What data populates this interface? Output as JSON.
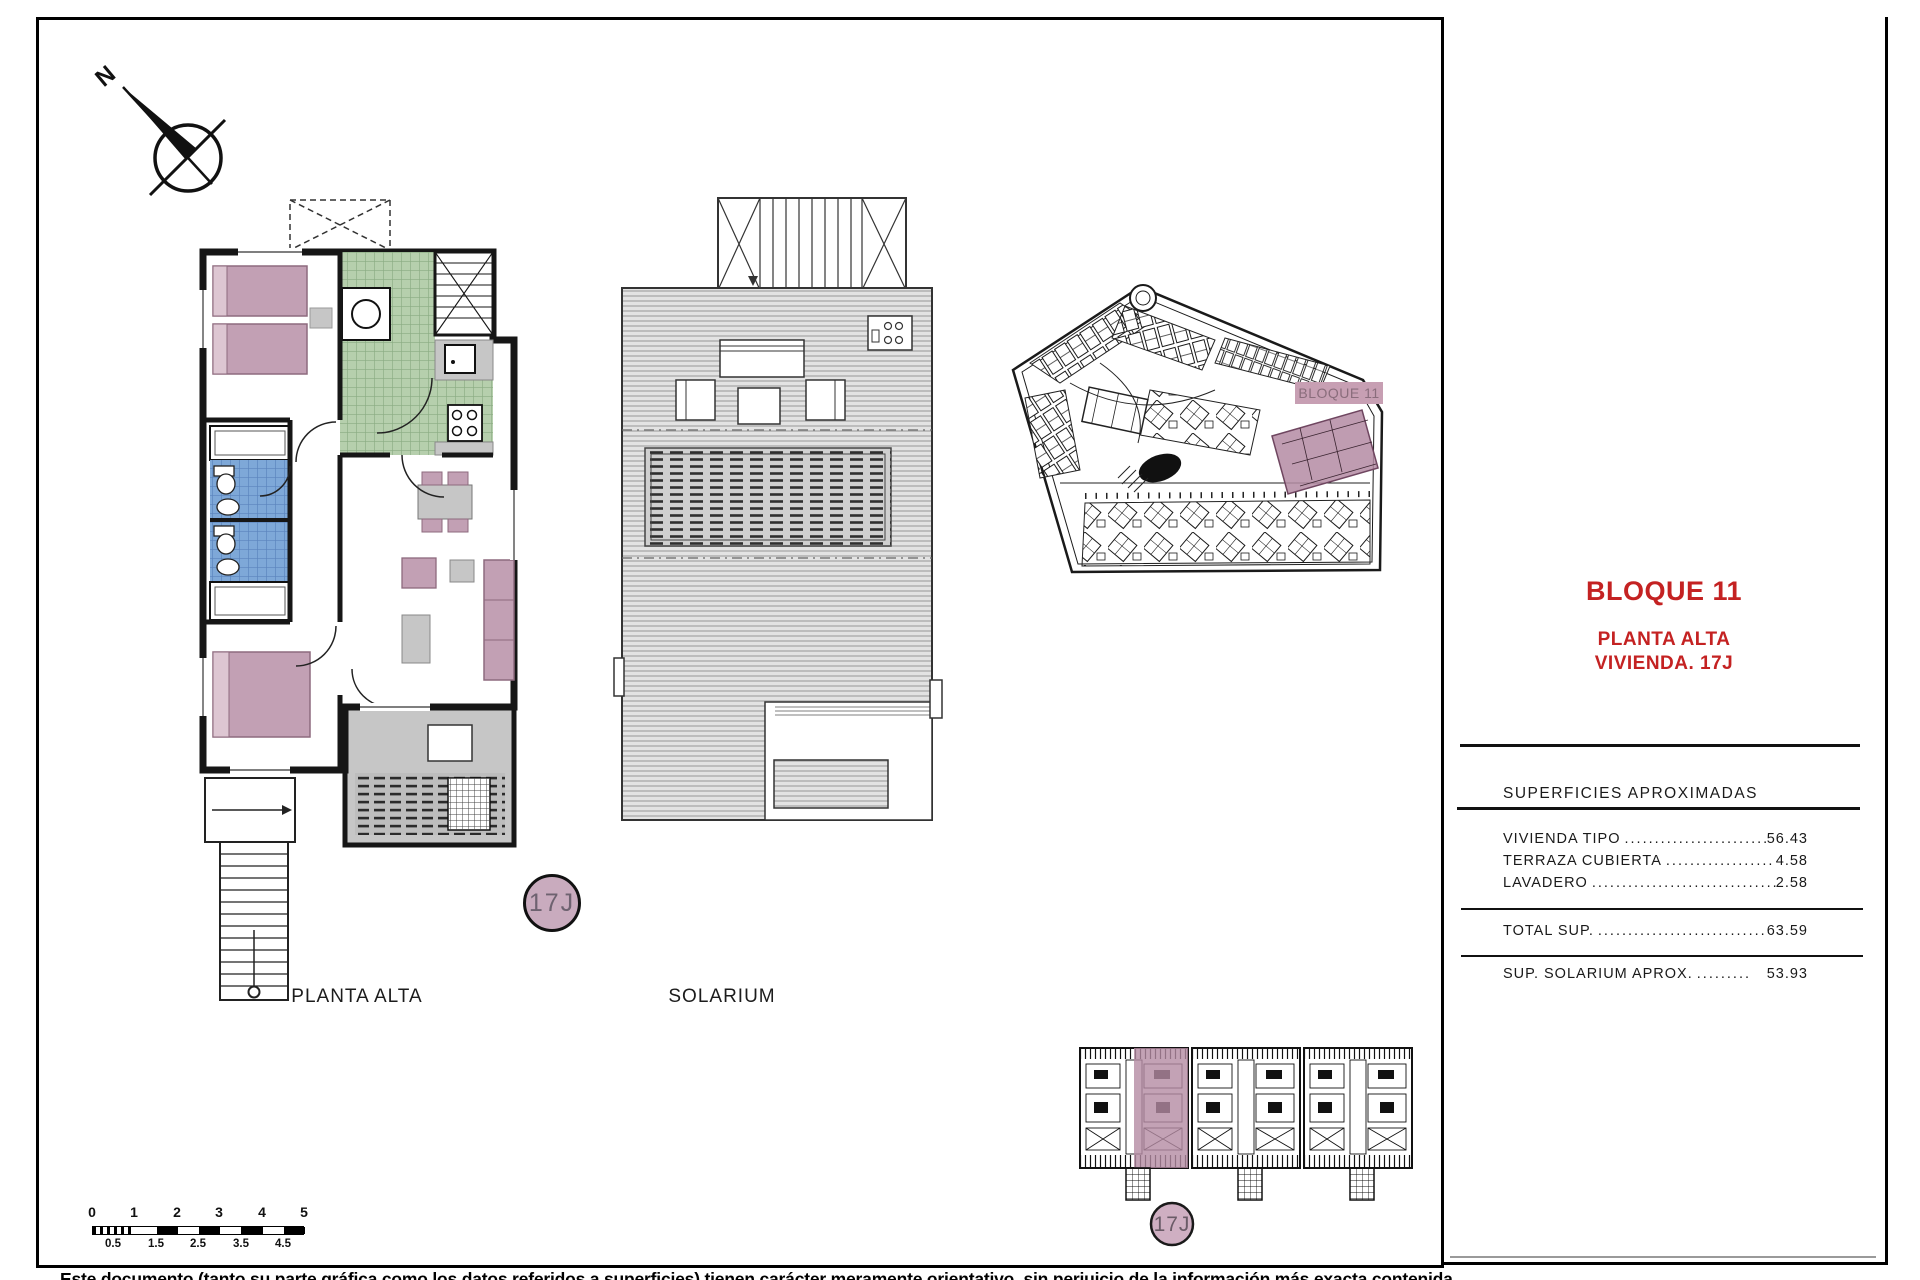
{
  "sidebar": {
    "title": "BLOQUE 11",
    "subtitle1": "PLANTA ALTA",
    "subtitle2": "VIVIENDA. 17J",
    "surfaces_header": "SUPERFICIES APROXIMADAS",
    "rows": [
      {
        "label": "VIVIENDA TIPO",
        "dots": "..........................",
        "value": "56.43"
      },
      {
        "label": "TERRAZA CUBIERTA",
        "dots": "..................",
        "value": "4.58"
      },
      {
        "label": "LAVADERO",
        "dots": "...................................",
        "value": "2.58"
      }
    ],
    "total_row": {
      "label": "TOTAL SUP.",
      "dots": "................................",
      "value": "63.59"
    },
    "solarium_row": {
      "label": "SUP. SOLARIUM APROX.",
      "dots": ".........",
      "value": "53.93"
    }
  },
  "plans": {
    "floor_plan_label": "PLANTA ALTA",
    "solarium_label": "SOLARIUM",
    "unit_badge": "17J",
    "site_block_label": "BLOQUE 11",
    "north_label": "N"
  },
  "scale_bar": {
    "top_ticks": [
      "0",
      "1",
      "2",
      "3",
      "4",
      "5"
    ],
    "bottom_ticks": [
      "0.5",
      "1.5",
      "2.5",
      "3.5",
      "4.5"
    ]
  },
  "footer": "Este documento (tanto su parte gráfica como los datos referidos a superficies) tienen carácter meramente orientativo, sin perjuicio de la información más exacta contenida",
  "colors": {
    "accent_red": "#c42222",
    "furniture_mauve": "#c2a0b4",
    "tile_green": "#b6cfad",
    "tile_blue": "#7ea8d8",
    "highlight_mauve": "#b48ba3"
  }
}
